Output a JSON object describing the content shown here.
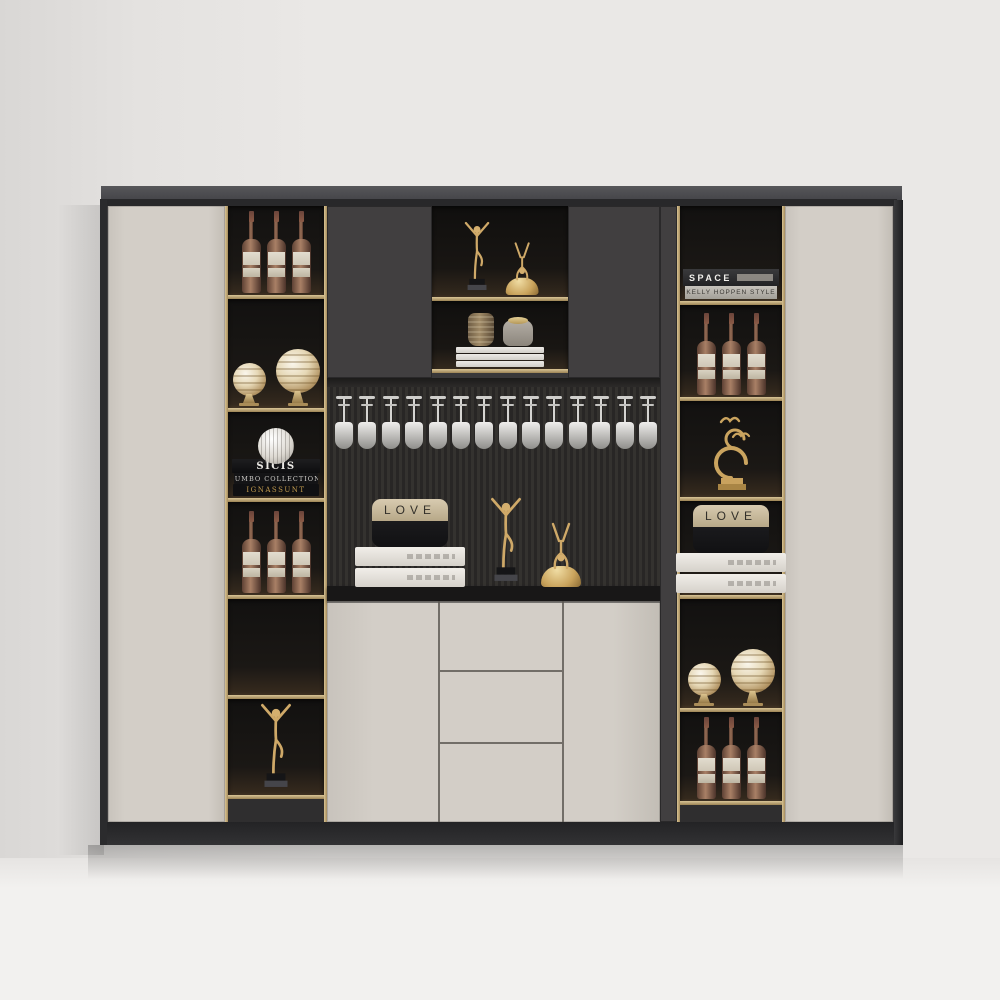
{
  "texts": {
    "love": "LOVE",
    "sicis_title": "SICIS",
    "sicis_subtitle": "JUMBO COLLECTION",
    "sicis_gold": "IGNASSUNT",
    "space_title": "SPACE",
    "space_subtitle": "KELLY HOPPEN STYLE"
  },
  "colors": {
    "wall": "#eae8e6",
    "floor": "#f2f1ef",
    "light": "#d3cec7",
    "dark": "#3e3d3e",
    "brass": "#bfa87a",
    "gold": "#cfa968",
    "interior": "#171513"
  },
  "glass_rack": {
    "count": 14
  },
  "columns": {
    "left": {
      "cells": [
        {
          "items": [
            {
              "type": "bottle-trio",
              "count": 3
            }
          ]
        },
        {
          "items": [
            {
              "type": "orb-pair"
            }
          ]
        },
        {
          "items": [
            {
              "type": "sicis-books"
            }
          ]
        },
        {
          "items": [
            {
              "type": "bottle-trio",
              "count": 3
            }
          ]
        },
        {
          "items": []
        },
        {
          "items": [
            {
              "type": "dancer"
            }
          ]
        }
      ]
    },
    "right": {
      "cells": [
        {
          "items": [
            {
              "type": "space-books"
            }
          ]
        },
        {
          "items": [
            {
              "type": "bottle-trio",
              "count": 3
            }
          ]
        },
        {
          "items": [
            {
              "type": "bird-sculpture"
            }
          ]
        },
        {
          "items": [
            {
              "type": "love-books",
              "book_count": 2
            }
          ]
        },
        {
          "items": [
            {
              "type": "orb-pair"
            }
          ]
        },
        {
          "items": [
            {
              "type": "bottle-trio",
              "count": 3
            }
          ]
        }
      ]
    }
  },
  "center": {
    "alcove_upper": {
      "items": [
        {
          "type": "dancer-duo",
          "scale": 0.82
        }
      ]
    },
    "alcove_lower": {
      "items": [
        {
          "type": "vase-books",
          "book_count": 3
        }
      ]
    },
    "counter": {
      "items": [
        {
          "type": "love-books",
          "book_count": 2
        },
        {
          "type": "dancer-duo",
          "scale": 1
        }
      ]
    }
  }
}
